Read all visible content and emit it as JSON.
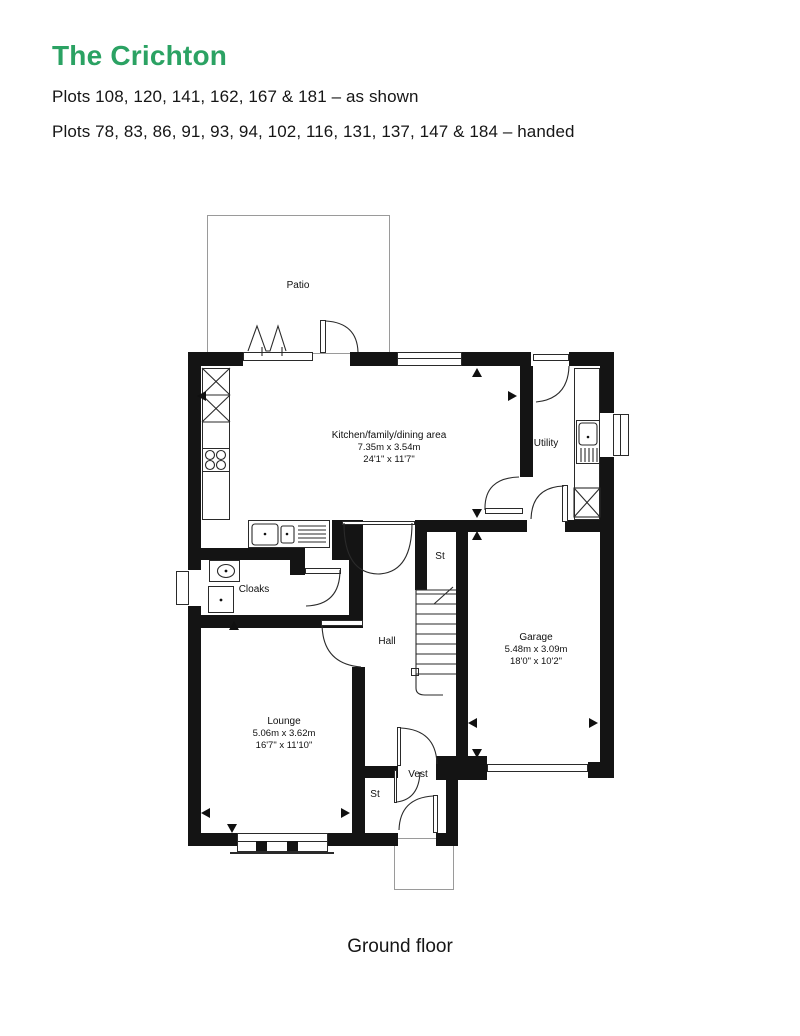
{
  "header": {
    "title": "The Crichton",
    "plots_line1": "Plots 108, 120, 141, 162, 167 & 181 – as shown",
    "plots_line2": "Plots 78, 83, 86, 91, 93, 94, 102, 116, 131, 137, 147 & 184 – handed"
  },
  "accent_color": "#2ba263",
  "floor_label": "Ground floor",
  "rooms": {
    "patio": {
      "label": "Patio"
    },
    "kitchen": {
      "label": "Kitchen/family/dining area",
      "metric": "7.35m x 3.54m",
      "imperial": "24'1\" x 11'7\""
    },
    "utility": {
      "label": "Utility"
    },
    "st_upper": {
      "label": "St"
    },
    "cloaks": {
      "label": "Cloaks"
    },
    "hall": {
      "label": "Hall"
    },
    "garage": {
      "label": "Garage",
      "metric": "5.48m x 3.09m",
      "imperial": "18'0\" x 10'2\""
    },
    "lounge": {
      "label": "Lounge",
      "metric": "5.06m x 3.62m",
      "imperial": "16'7\" x 11'10\""
    },
    "vest": {
      "label": "Vest"
    },
    "st_lower": {
      "label": "St"
    }
  }
}
